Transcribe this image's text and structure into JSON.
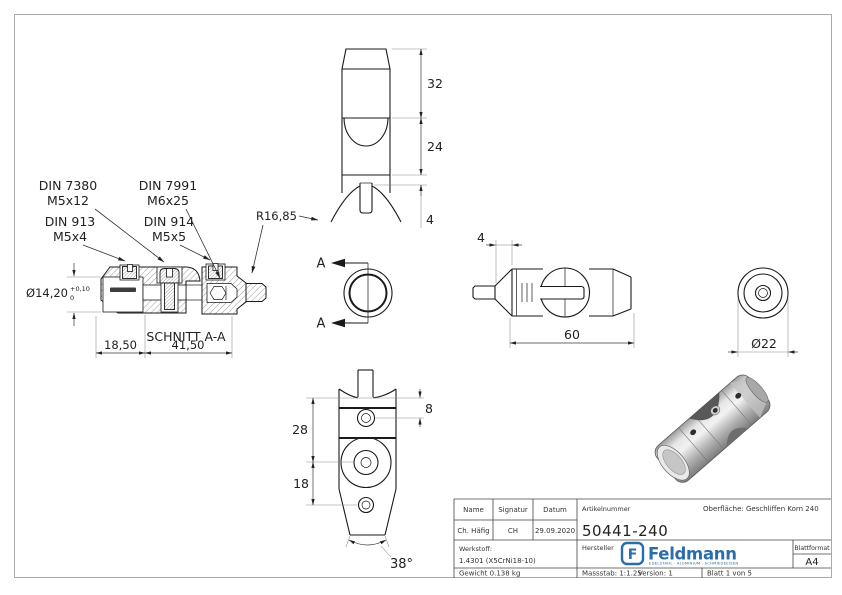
{
  "drawing": {
    "callouts": {
      "din7380_l1": "DIN 7380",
      "din7380_l2": "M5x12",
      "din7991_l1": "DIN 7991",
      "din7991_l2": "M6x25",
      "din913_l1": "DIN 913",
      "din913_l2": "M5x4",
      "din914_l1": "DIN 914",
      "din914_l2": "M5x5",
      "radius": "R16,85",
      "schnitt": "SCHNITT A-A",
      "section_letter": "A"
    },
    "dims": {
      "h32": "32",
      "h24": "24",
      "h4": "4",
      "dia": "Ø14,20",
      "tol_plus": "+0,10",
      "tol_zero": "0",
      "w1850": "18,50",
      "w4150": "41,50",
      "side4": "4",
      "side60": "60",
      "dia22": "Ø22",
      "f8": "8",
      "f28": "28",
      "f18": "18",
      "ang": "38°"
    }
  },
  "titleblock": {
    "name_label": "Name",
    "signatur_label": "Signatur",
    "datum_label": "Datum",
    "name": "Ch. Häfig",
    "signatur": "CH",
    "datum": "29.09.2020",
    "artikelnummer_label": "Artikelnummer",
    "artikelnummer": "50441-240",
    "oberflaeche": "Oberfläche:  Geschliffen Korn 240",
    "werkstoff_label": "Werkstoff:",
    "werkstoff": "1.4301 (X5CrNi18-10)",
    "hersteller_label": "Hersteller",
    "logo_letter": "F",
    "logo_text": "Feldmann",
    "logo_tagline": "EDELSTAHL · ALUMINIUM · SCHMIEDEEISEN",
    "blattformat_label": "Blattformat",
    "blattformat": "A4",
    "gewicht": "Gewicht 0.138 kg",
    "massstab": "Massstab: 1:1.25",
    "version": "Version: 1",
    "blatt": "Blatt 1 von 5"
  },
  "colors": {
    "line": "#1a1a1a",
    "frame": "#aaaaaa",
    "logo_blue": "#2b6da8"
  }
}
